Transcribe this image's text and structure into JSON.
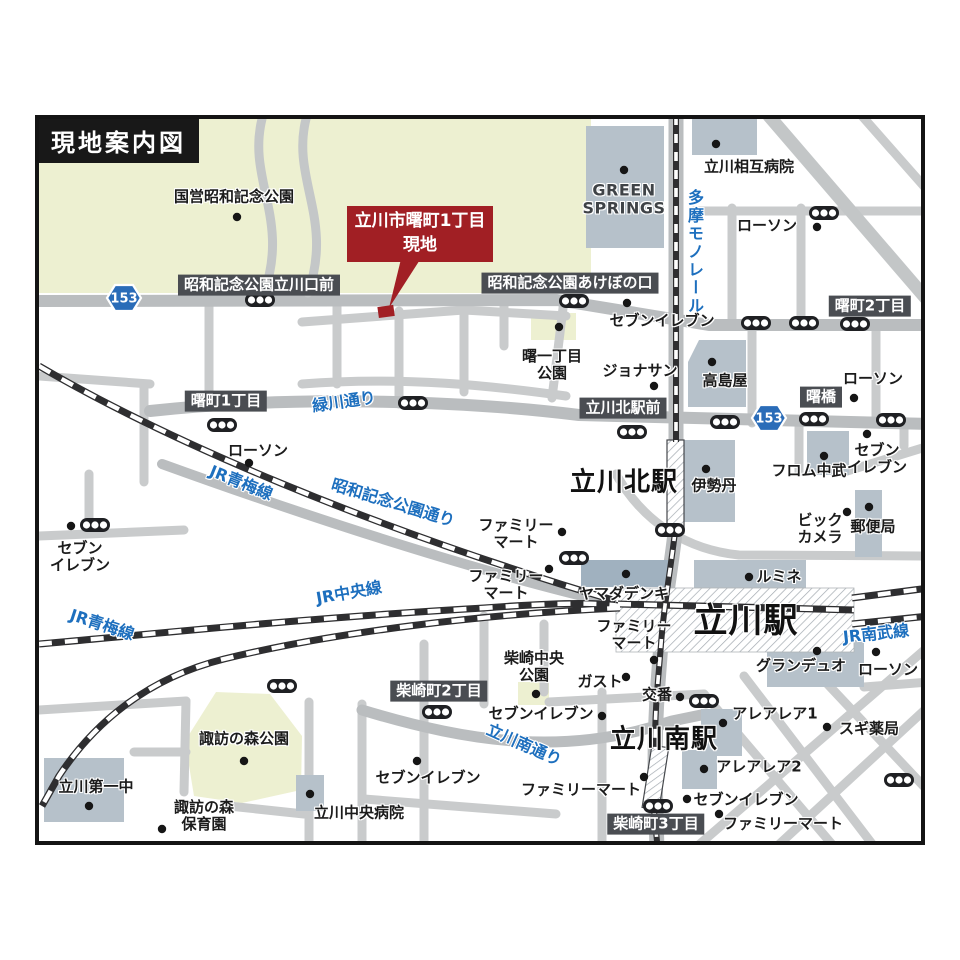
{
  "title": "現地案内図",
  "map": {
    "callout": {
      "line1": "立川市曙町1丁目",
      "line2": "現地"
    },
    "colors": {
      "park": "#edf0d1",
      "road_major": "#babdbf",
      "road_minor": "#c9cbcc",
      "building": "#b6c1ca",
      "building_dark": "#a0b1bf",
      "rail": "#2e2e30",
      "label_box": "#4a4d52",
      "accent_red": "#a11f24",
      "road_text_blue": "#1d6fbe",
      "route_shield_blue": "#2a6cb8"
    },
    "routes": [
      {
        "label": "153",
        "x": 120,
        "y": 294
      },
      {
        "label": "153",
        "x": 765,
        "y": 414
      }
    ],
    "labels": [
      {
        "text": "国営昭和記念公園",
        "x": 230,
        "y": 193,
        "type": "place"
      },
      {
        "lines": [
          "GREEN",
          "SPRINGS"
        ],
        "x": 620,
        "y": 196,
        "type": "latin"
      },
      {
        "text": "立川相互病院",
        "x": 745,
        "y": 163,
        "type": "place"
      },
      {
        "text": "ローソン",
        "x": 763,
        "y": 222,
        "type": "place"
      },
      {
        "text": "セブンイレブン",
        "x": 658,
        "y": 317,
        "type": "place"
      },
      {
        "text": "ジョナサン",
        "x": 636,
        "y": 367,
        "type": "place"
      },
      {
        "text": "高島屋",
        "x": 721,
        "y": 377,
        "type": "place"
      },
      {
        "text": "ローソン",
        "x": 869,
        "y": 375,
        "type": "place"
      },
      {
        "lines": [
          "曙一丁目",
          "公園"
        ],
        "x": 548,
        "y": 361,
        "type": "place"
      },
      {
        "text": "ローソン",
        "x": 254,
        "y": 447,
        "type": "place"
      },
      {
        "lines": [
          "セブン",
          "イレブン"
        ],
        "x": 76,
        "y": 553,
        "type": "place"
      },
      {
        "text": "伊勢丹",
        "x": 710,
        "y": 482,
        "type": "place"
      },
      {
        "text": "フロム中武",
        "x": 805,
        "y": 467,
        "type": "place"
      },
      {
        "lines": [
          "セブン",
          "イレブン"
        ],
        "x": 873,
        "y": 455,
        "type": "place"
      },
      {
        "lines": [
          "ビック",
          "カメラ"
        ],
        "x": 816,
        "y": 525,
        "type": "place"
      },
      {
        "text": "郵便局",
        "x": 869,
        "y": 523,
        "type": "place"
      },
      {
        "lines": [
          "ファミリー",
          "マート"
        ],
        "x": 512,
        "y": 530,
        "type": "place"
      },
      {
        "lines": [
          "ファミリー",
          "マート"
        ],
        "x": 502,
        "y": 581,
        "type": "place"
      },
      {
        "text": "ヤマダデンキ",
        "x": 620,
        "y": 590,
        "type": "place"
      },
      {
        "lines": [
          "ファミリー",
          "マート"
        ],
        "x": 630,
        "y": 631,
        "type": "place"
      },
      {
        "text": "ルミネ",
        "x": 775,
        "y": 573,
        "type": "place"
      },
      {
        "text": "グランデュオ",
        "x": 797,
        "y": 662,
        "type": "place"
      },
      {
        "text": "ローソン",
        "x": 884,
        "y": 666,
        "type": "place"
      },
      {
        "lines": [
          "柴崎中央",
          "公園"
        ],
        "x": 530,
        "y": 663,
        "type": "place"
      },
      {
        "text": "ガスト",
        "x": 596,
        "y": 678,
        "type": "place"
      },
      {
        "text": "交番",
        "x": 653,
        "y": 691,
        "type": "place"
      },
      {
        "text": "アレアレア1",
        "x": 771,
        "y": 710,
        "type": "place"
      },
      {
        "text": "スギ薬局",
        "x": 865,
        "y": 725,
        "type": "place"
      },
      {
        "text": "アレアレア2",
        "x": 755,
        "y": 763,
        "type": "place"
      },
      {
        "text": "セブンイレブン",
        "x": 742,
        "y": 796,
        "type": "place"
      },
      {
        "text": "ファミリーマート",
        "x": 779,
        "y": 820,
        "type": "place"
      },
      {
        "text": "セブンイレブン",
        "x": 537,
        "y": 710,
        "type": "place"
      },
      {
        "text": "セブンイレブン",
        "x": 424,
        "y": 774,
        "type": "place"
      },
      {
        "text": "ファミリーマート",
        "x": 577,
        "y": 786,
        "type": "place"
      },
      {
        "text": "立川中央病院",
        "x": 355,
        "y": 809,
        "type": "place"
      },
      {
        "lines": [
          "諏訪の森",
          "保育園"
        ],
        "x": 200,
        "y": 812,
        "type": "place"
      },
      {
        "text": "立川第一中",
        "x": 92,
        "y": 783,
        "type": "place"
      },
      {
        "text": "諏訪の森公園",
        "x": 240,
        "y": 735,
        "type": "place"
      },
      {
        "text": "立川北駅",
        "x": 620,
        "y": 479,
        "type": "big",
        "size": 26
      },
      {
        "text": "立川駅",
        "x": 742,
        "y": 617,
        "type": "big",
        "size": 34
      },
      {
        "text": "立川南駅",
        "x": 660,
        "y": 736,
        "type": "big",
        "size": 26
      },
      {
        "text": "昭和記念公園立川口前",
        "x": 255,
        "y": 281,
        "type": "box"
      },
      {
        "text": "昭和記念公園あけぼの口",
        "x": 566,
        "y": 279,
        "type": "box"
      },
      {
        "text": "曙町2丁目",
        "x": 866,
        "y": 302,
        "type": "box"
      },
      {
        "text": "曙町1丁目",
        "x": 222,
        "y": 397,
        "type": "box"
      },
      {
        "text": "立川北駅前",
        "x": 619,
        "y": 404,
        "type": "box"
      },
      {
        "text": "曙橋",
        "x": 817,
        "y": 393,
        "type": "box"
      },
      {
        "text": "柴崎町2丁目",
        "x": 435,
        "y": 687,
        "type": "box"
      },
      {
        "text": "柴崎町3丁目",
        "x": 652,
        "y": 820,
        "type": "box"
      },
      {
        "text": "多摩モノレール",
        "x": 690,
        "y": 248,
        "type": "vert"
      },
      {
        "text": "緑川通り",
        "x": 340,
        "y": 398,
        "type": "blue",
        "rot": -8
      },
      {
        "text": "JR青梅線",
        "x": 237,
        "y": 479,
        "type": "blue",
        "rot": 22
      },
      {
        "text": "昭和記念公園通り",
        "x": 389,
        "y": 499,
        "type": "blue",
        "rot": 17
      },
      {
        "text": "JR中央線",
        "x": 345,
        "y": 589,
        "type": "blue",
        "rot": -10
      },
      {
        "text": "JR青梅線",
        "x": 98,
        "y": 621,
        "type": "blue",
        "rot": 18
      },
      {
        "text": "JR南武線",
        "x": 872,
        "y": 630,
        "type": "blue",
        "rot": -6
      },
      {
        "text": "立川南通り",
        "x": 520,
        "y": 741,
        "type": "blue",
        "rot": 24
      }
    ],
    "signals": [
      [
        256,
        296
      ],
      [
        570,
        297
      ],
      [
        820,
        209
      ],
      [
        752,
        319
      ],
      [
        800,
        319
      ],
      [
        851,
        320
      ],
      [
        218,
        421
      ],
      [
        409,
        399
      ],
      [
        628,
        428
      ],
      [
        721,
        418
      ],
      [
        810,
        415
      ],
      [
        887,
        416
      ],
      [
        91,
        521
      ],
      [
        666,
        526
      ],
      [
        570,
        554
      ],
      [
        278,
        682
      ],
      [
        433,
        708
      ],
      [
        700,
        697
      ],
      [
        654,
        802
      ],
      [
        895,
        776
      ]
    ],
    "poi_dots": [
      [
        233,
        213
      ],
      [
        620,
        166
      ],
      [
        712,
        140
      ],
      [
        813,
        223
      ],
      [
        623,
        299
      ],
      [
        555,
        323
      ],
      [
        650,
        382
      ],
      [
        708,
        358
      ],
      [
        850,
        394
      ],
      [
        245,
        459
      ],
      [
        67,
        522
      ],
      [
        702,
        465
      ],
      [
        820,
        452
      ],
      [
        863,
        430
      ],
      [
        865,
        503
      ],
      [
        843,
        508
      ],
      [
        622,
        570
      ],
      [
        545,
        565
      ],
      [
        558,
        528
      ],
      [
        745,
        573
      ],
      [
        813,
        647
      ],
      [
        872,
        648
      ],
      [
        650,
        656
      ],
      [
        622,
        673
      ],
      [
        676,
        693
      ],
      [
        719,
        719
      ],
      [
        823,
        723
      ],
      [
        700,
        765
      ],
      [
        683,
        795
      ],
      [
        715,
        810
      ],
      [
        598,
        712
      ],
      [
        413,
        757
      ],
      [
        640,
        773
      ],
      [
        306,
        790
      ],
      [
        158,
        825
      ],
      [
        85,
        802
      ],
      [
        240,
        757
      ],
      [
        532,
        690
      ]
    ]
  }
}
